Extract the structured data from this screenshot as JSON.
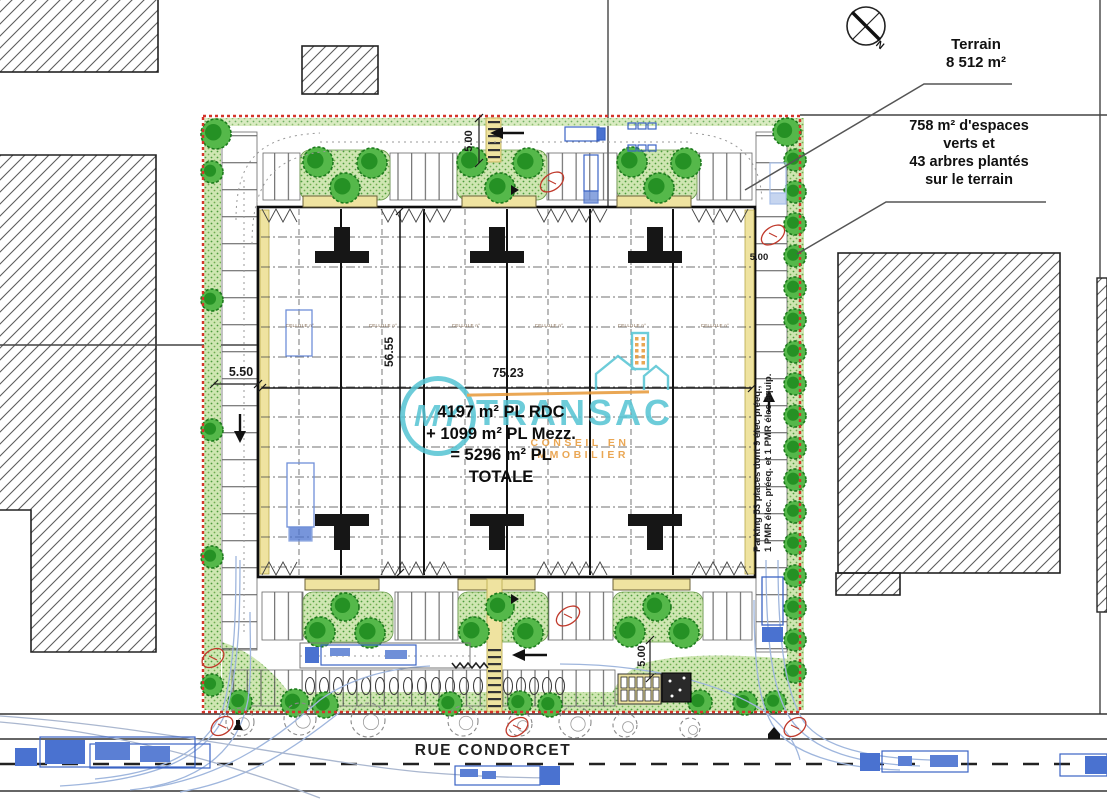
{
  "annotations": {
    "terrain_label": "Terrain",
    "terrain_area": "8 512 m²",
    "green_note_lines": [
      "758 m² d'espaces",
      "verts et",
      "43 arbres plantés",
      "sur le terrain"
    ]
  },
  "compass": {
    "north_label": "N"
  },
  "building": {
    "area_lines": [
      "4197 m² PL RDC",
      "+ 1099 m² PL Mezz.",
      "= 5296 m² PL",
      "TOTALE"
    ],
    "cell_label": "CELLULE n°"
  },
  "dimensions": {
    "top": "5.00",
    "left": "5.50",
    "height": "56.55",
    "width": "75.23",
    "right": "5.00",
    "bottom": "5.00"
  },
  "parking_note": {
    "line1": "Parking 53 places dont 9 élec préeq.,",
    "line2": "1 PMR élec. préeq. et 1 PMR élec équip."
  },
  "street": {
    "name": "RUE CONDORCET"
  },
  "watermark": {
    "brand_my": "MY",
    "brand_transac": "TRANSAC",
    "tagline": "CONSEIL EN IMMOBILIER"
  },
  "colors": {
    "brand_teal": "#58c5d4",
    "brand_orange": "#e79a3b",
    "boundary_red": "#d4342a",
    "tree_green": "#2f9e2f",
    "truck_blue": "#4a72d0",
    "canopy_yellow": "#efe3a0"
  }
}
